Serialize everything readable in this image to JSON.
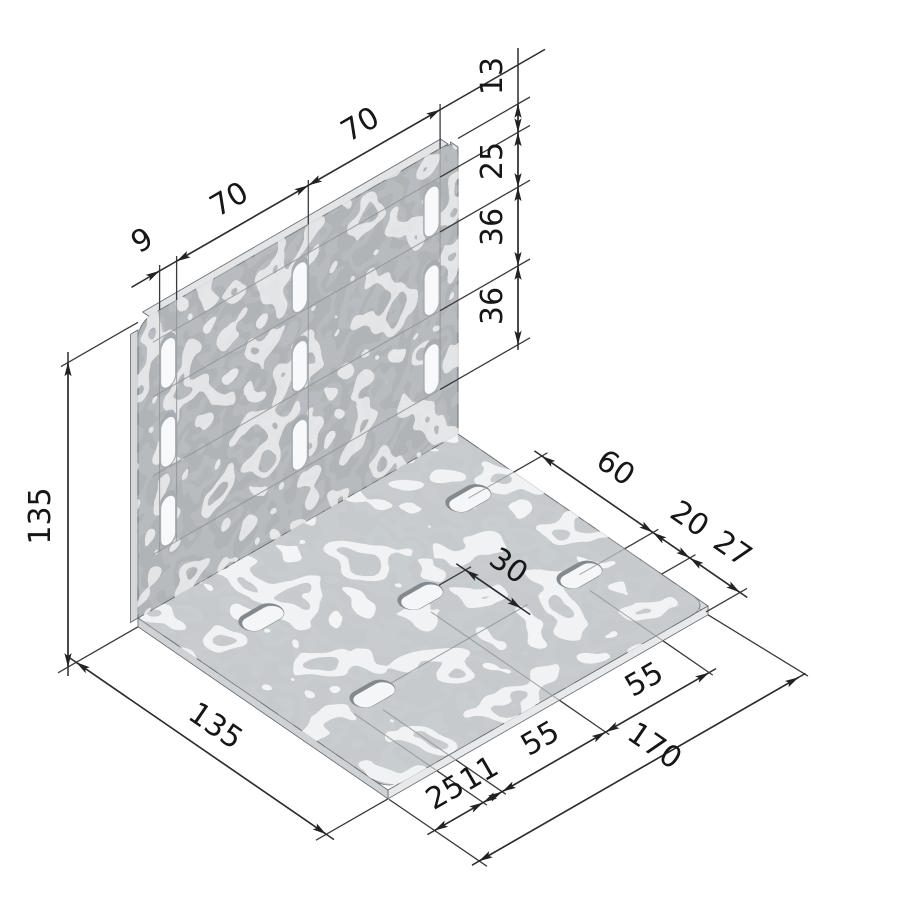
{
  "drawing": {
    "type": "isometric technical drawing",
    "part": "galvanized steel angle bracket with slotted holes",
    "colors": {
      "background": "#ffffff",
      "plate_face": "#b0b4b7",
      "base_face": "#c6cacc",
      "edge_light": "#e6e8ea",
      "dimension_lines": "#2e2e2e",
      "slot_fill": "#f5f7f8",
      "slot_rim": "#84898d"
    },
    "labels": {
      "slot_width": "9",
      "col_spacing_1": "70",
      "col_spacing_2": "70",
      "top_to_slot": "13",
      "slot_length": "25",
      "row_spacing_1": "36",
      "row_spacing_2": "36",
      "plate_height": "135",
      "base_depth": "135",
      "base_row_span": "60",
      "base_front_inset": "20",
      "base_edge_margin": "27",
      "base_mid_offset": "30",
      "base_left_margin": "25",
      "base_slot_half": "11",
      "base_col_spacing_1": "55",
      "base_col_spacing_2": "55",
      "overall_length": "170"
    }
  }
}
